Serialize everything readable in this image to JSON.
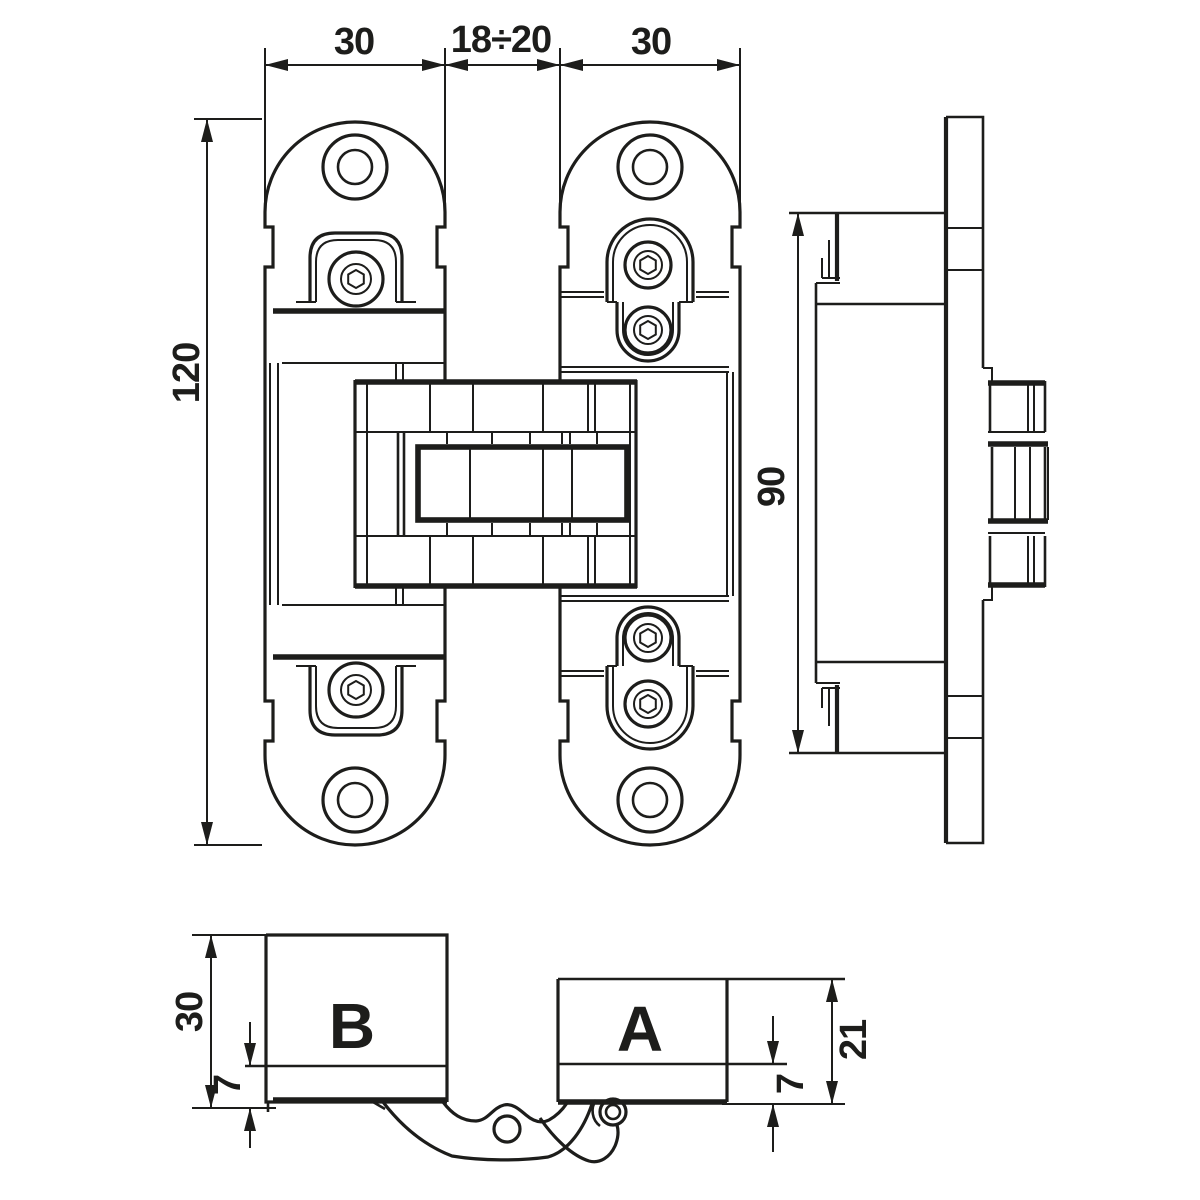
{
  "drawing": {
    "background": "#ffffff",
    "line_color": "#1d1d1b",
    "front_view": {
      "dim_plate_left_width": "30",
      "dim_gap_width": "18÷20",
      "dim_plate_right_width": "30",
      "dim_total_height": "120"
    },
    "side_view": {
      "dim_body_height": "90"
    },
    "open_view": {
      "label_left_block": "B",
      "label_right_block": "A",
      "dim_left_block_height": "30",
      "dim_left_recess_depth": "7",
      "dim_right_recess_depth": "7",
      "dim_right_block_height": "21"
    }
  }
}
